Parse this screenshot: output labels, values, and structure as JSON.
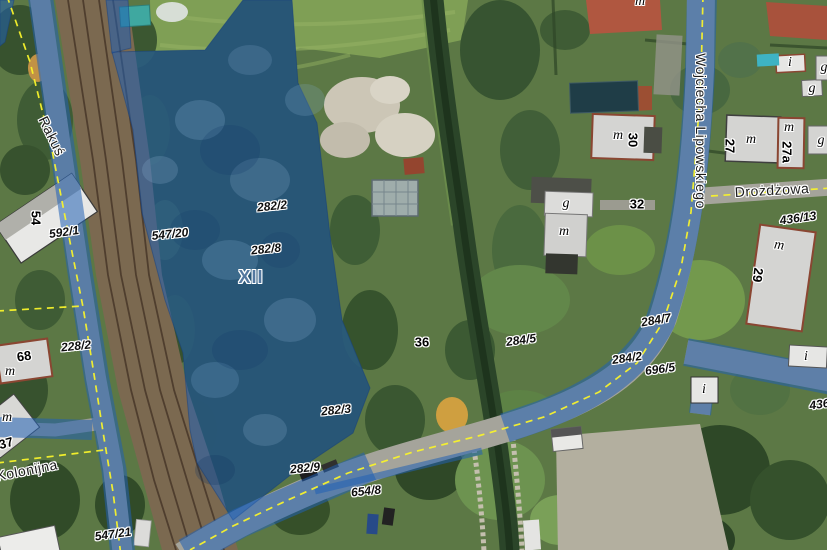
{
  "map": {
    "colors": {
      "selection_overlay_blue": "#2061b5",
      "boundary_yellow": "#f8f32b",
      "building_fill": "#d4d4d2",
      "building_outline": "#8a4632",
      "section_label_color": "#54789f"
    },
    "labels": {
      "section_label": {
        "text": "XII",
        "x": 251,
        "y": 277,
        "rot": 0
      },
      "parcel_numbers": [
        {
          "text": "592/1",
          "x": 64,
          "y": 232,
          "rot": -8
        },
        {
          "text": "547/20",
          "x": 170,
          "y": 234,
          "rot": -6
        },
        {
          "text": "282/2",
          "x": 272,
          "y": 206,
          "rot": -6
        },
        {
          "text": "282/8",
          "x": 266,
          "y": 249,
          "rot": -6
        },
        {
          "text": "228/2",
          "x": 76,
          "y": 346,
          "rot": -6
        },
        {
          "text": "282/3",
          "x": 336,
          "y": 410,
          "rot": -6
        },
        {
          "text": "282/9",
          "x": 305,
          "y": 468,
          "rot": -6
        },
        {
          "text": "654/8",
          "x": 366,
          "y": 491,
          "rot": -6
        },
        {
          "text": "547/21",
          "x": 113,
          "y": 534,
          "rot": -8
        },
        {
          "text": "284/5",
          "x": 521,
          "y": 340,
          "rot": -8
        },
        {
          "text": "284/7",
          "x": 656,
          "y": 320,
          "rot": -10
        },
        {
          "text": "284/2",
          "x": 627,
          "y": 358,
          "rot": -8
        },
        {
          "text": "696/5",
          "x": 660,
          "y": 369,
          "rot": -8
        },
        {
          "text": "436/13",
          "x": 798,
          "y": 218,
          "rot": -8
        },
        {
          "text": "436/",
          "x": 821,
          "y": 404,
          "rot": -8
        }
      ],
      "street_names": [
        {
          "text": "Rakuś",
          "x": 52,
          "y": 136,
          "rot": 64
        },
        {
          "text": "Kolonijna",
          "x": 27,
          "y": 470,
          "rot": -11
        },
        {
          "text": "Wojciecha Lipowskiego",
          "x": 701,
          "y": 131,
          "rot": 90
        },
        {
          "text": "Drożdżowa",
          "x": 772,
          "y": 190,
          "rot": -3
        }
      ],
      "house_numbers": [
        {
          "text": "54",
          "x": 36,
          "y": 218,
          "rot": 90
        },
        {
          "text": "68",
          "x": 24,
          "y": 356,
          "rot": -8
        },
        {
          "text": "37",
          "x": 6,
          "y": 443,
          "rot": -15
        },
        {
          "text": "30",
          "x": 633,
          "y": 140,
          "rot": 90
        },
        {
          "text": "32",
          "x": 637,
          "y": 204,
          "rot": 0
        },
        {
          "text": "36",
          "x": 422,
          "y": 342,
          "rot": 0
        },
        {
          "text": "27",
          "x": 730,
          "y": 146,
          "rot": 90
        },
        {
          "text": "27a",
          "x": 787,
          "y": 152,
          "rot": 90
        },
        {
          "text": "29",
          "x": 758,
          "y": 275,
          "rot": 97
        }
      ],
      "building_letters": [
        {
          "text": "m",
          "x": 10,
          "y": 372,
          "rot": 0
        },
        {
          "text": "m",
          "x": 7,
          "y": 418,
          "rot": 0
        },
        {
          "text": "g",
          "x": 566,
          "y": 204,
          "rot": 0
        },
        {
          "text": "m",
          "x": 564,
          "y": 232,
          "rot": 0
        },
        {
          "text": "m",
          "x": 618,
          "y": 136,
          "rot": 0
        },
        {
          "text": "m",
          "x": 640,
          "y": 2,
          "rot": 0
        },
        {
          "text": "m",
          "x": 751,
          "y": 140,
          "rot": 0
        },
        {
          "text": "m",
          "x": 789,
          "y": 128,
          "rot": 0
        },
        {
          "text": "g",
          "x": 821,
          "y": 141,
          "rot": 0
        },
        {
          "text": "g",
          "x": 812,
          "y": 89,
          "rot": 0
        },
        {
          "text": "g",
          "x": 824,
          "y": 68,
          "rot": 0
        },
        {
          "text": "i",
          "x": 790,
          "y": 63,
          "rot": 0
        },
        {
          "text": "m",
          "x": 779,
          "y": 246,
          "rot": 8
        },
        {
          "text": "i",
          "x": 806,
          "y": 357,
          "rot": 0
        },
        {
          "text": "i",
          "x": 704,
          "y": 390,
          "rot": 0
        }
      ]
    }
  }
}
